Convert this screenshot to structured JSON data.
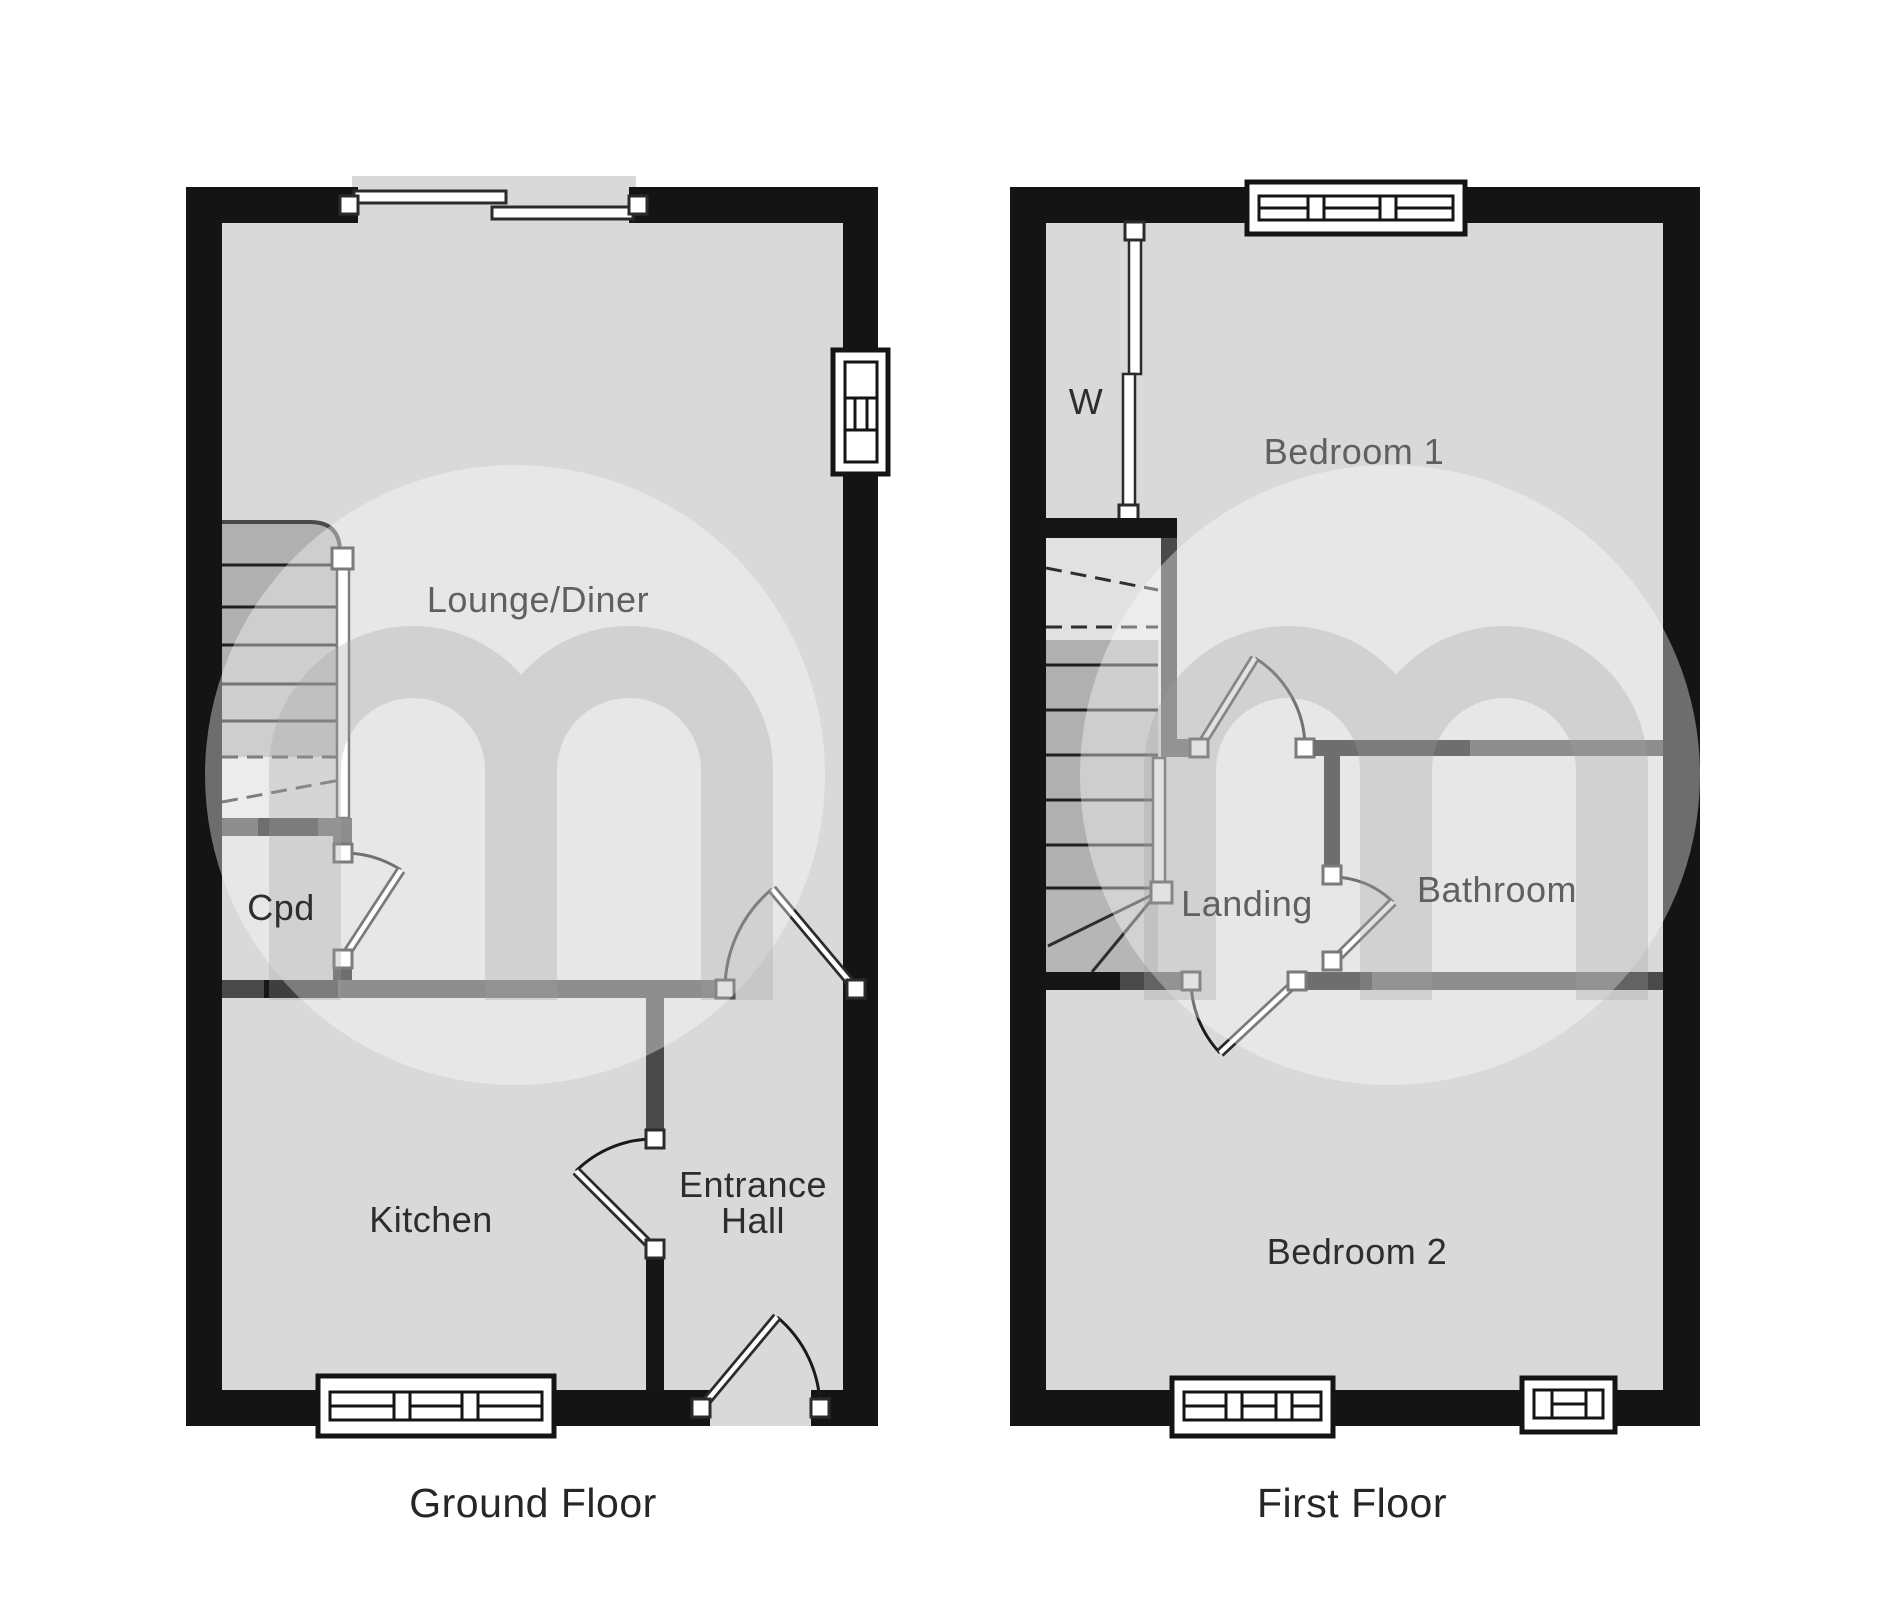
{
  "document": {
    "type": "floorplan",
    "watermark_letter": "m"
  },
  "colors": {
    "background": "#ffffff",
    "floor": "#d9d9d9",
    "exterior_wall": "#141414",
    "interior_wall_gray": "#4a4a4a",
    "interior_wall_black": "#161616",
    "stair_tread": "#b0b0b0",
    "stair_lower": "#e1e1e1",
    "label_dark": "#2d2d2d",
    "label_muted": "#606060",
    "caption": "#262626"
  },
  "ground_floor": {
    "caption": "Ground Floor",
    "labels": {
      "lounge_diner": "Lounge/Diner",
      "cupboard": "Cpd",
      "kitchen": "Kitchen",
      "entrance_hall_line1": "Entrance",
      "entrance_hall_line2": "Hall"
    },
    "features": {
      "windows": [
        "sliding-patio-door-top",
        "side-window-right",
        "kitchen-window-bottom"
      ],
      "doors": [
        "cupboard-door",
        "kitchen-door",
        "lounge-door",
        "front-entrance-door"
      ],
      "stairs": "staircase-up"
    }
  },
  "first_floor": {
    "caption": "First Floor",
    "labels": {
      "wardrobe": "W",
      "bedroom1": "Bedroom 1",
      "landing": "Landing",
      "bathroom": "Bathroom",
      "bedroom2": "Bedroom 2"
    },
    "features": {
      "windows": [
        "bedroom1-window-top",
        "bedroom2-window-bottom-left",
        "bedroom2-window-bottom-right"
      ],
      "doors": [
        "bedroom1-door",
        "bathroom-door",
        "bedroom2-door"
      ],
      "stairs": "staircase-down"
    }
  }
}
